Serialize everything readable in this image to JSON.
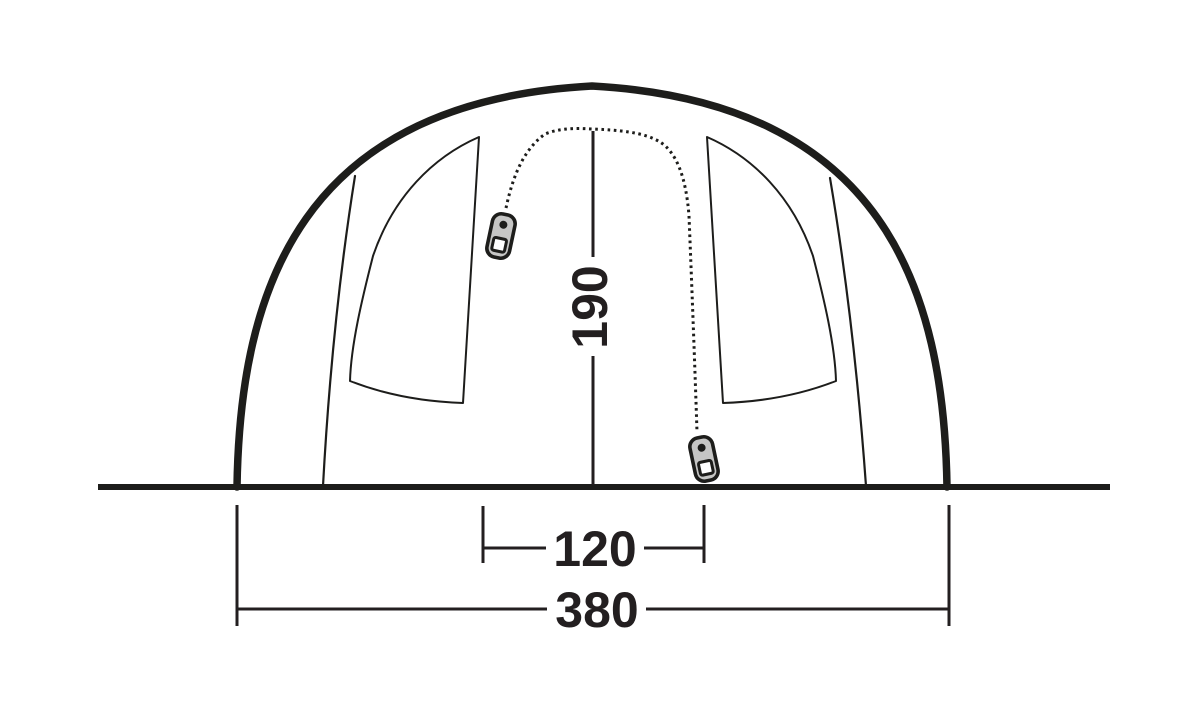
{
  "diagram": {
    "type": "tent-front-elevation-drawing",
    "dimensions": {
      "height": {
        "label": "190",
        "value": 190
      },
      "door_width": {
        "label": "120",
        "value": 120
      },
      "total_width": {
        "label": "380",
        "value": 380
      }
    },
    "colors": {
      "line": "#1d1d1b",
      "text": "#231f20",
      "zipper_pull_fill": "#c6c6c5",
      "background": "#ffffff"
    },
    "icons": {
      "left_zipper": "zipper-pull-icon",
      "right_zipper": "zipper-pull-icon"
    }
  }
}
